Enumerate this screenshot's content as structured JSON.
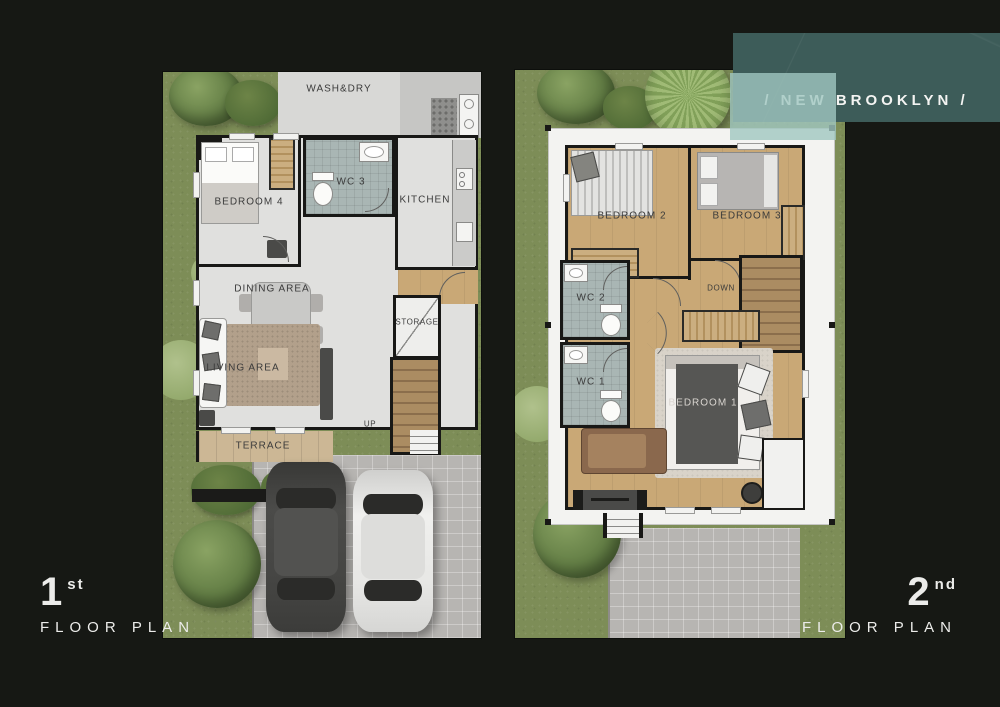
{
  "banner": {
    "text": "/ NEW BROOKLYN /"
  },
  "captions": {
    "first_number": "1",
    "first_suffix": "st",
    "first_label": "FLOOR PLAN",
    "second_number": "2",
    "second_suffix": "nd",
    "second_label": "FLOOR PLAN"
  },
  "floor1": {
    "washdry": "WASH&DRY",
    "wc3": "WC 3",
    "kitchen": "KITCHEN",
    "bedroom4": "BEDROOM 4",
    "dining": "DINING AREA",
    "living": "LIVING AREA",
    "storage": "STORAGE",
    "up": "UP",
    "terrace": "TERRACE"
  },
  "floor2": {
    "bedroom2": "BEDROOM 2",
    "bedroom3": "BEDROOM 3",
    "wc2": "WC 2",
    "wc1": "WC 1",
    "down": "DOWN",
    "bedroom1": "BEDROOM 1"
  },
  "colors": {
    "background": "#161814",
    "banner_teal": "#3d5c59",
    "banner_overlay": "#a0c7c1",
    "garden_green": "#7d8d57",
    "floor_gray": "#e0e0de",
    "wood_floor": "#c9a876",
    "tile_gray": "#a9b6b4",
    "wall_black": "#181816",
    "driveway_gray": "#b7b5b2",
    "terrace_tan": "#ccb795",
    "text_light": "#ececea",
    "label_dark": "#3b3b3b"
  }
}
